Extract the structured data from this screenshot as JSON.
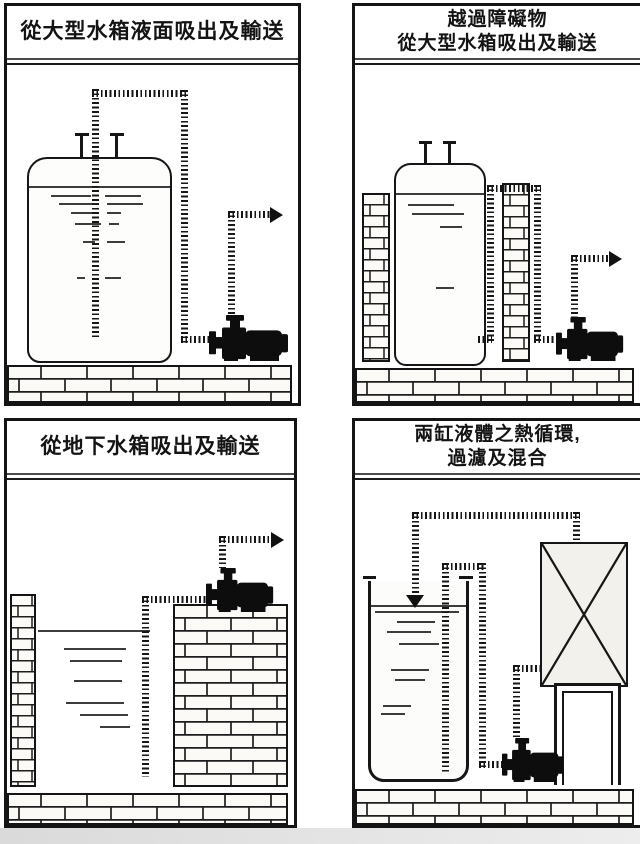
{
  "document": {
    "kind": "pump-application-diagram-sheet",
    "language": "zh-Hant",
    "panel_count": 4
  },
  "colors": {
    "ink": "#141414",
    "paper": "#ffffff",
    "brick_fill": "#fbfaf7",
    "liquid_dash": "#3c3c3c",
    "scan_band": "#dedede"
  },
  "panels": [
    {
      "name": "suction-from-large-tank-surface",
      "title_lines": [
        "從大型水箱液面吸出及輸送"
      ]
    },
    {
      "name": "over-obstacles-suction-from-large-tank",
      "title_lines": [
        "越過障礙物",
        "從大型水箱吸出及輸送"
      ]
    },
    {
      "name": "suction-from-underground-tank",
      "title_lines": [
        "從地下水箱吸出及輸送"
      ]
    },
    {
      "name": "two-tank-heat-circulation-filter-mix",
      "title_lines": [
        "兩缸液體之熱循環,",
        "過濾及混合"
      ]
    }
  ],
  "icons": {
    "pump": "black self-priming pump silhouette",
    "flow_arrow_right": "solid right-pointing triangle",
    "flow_arrow_down": "solid down-pointing triangle",
    "pipe": "striped dashed pipe line",
    "brick": "brick masonry pattern",
    "filter_box": "rectangle with X cross"
  }
}
